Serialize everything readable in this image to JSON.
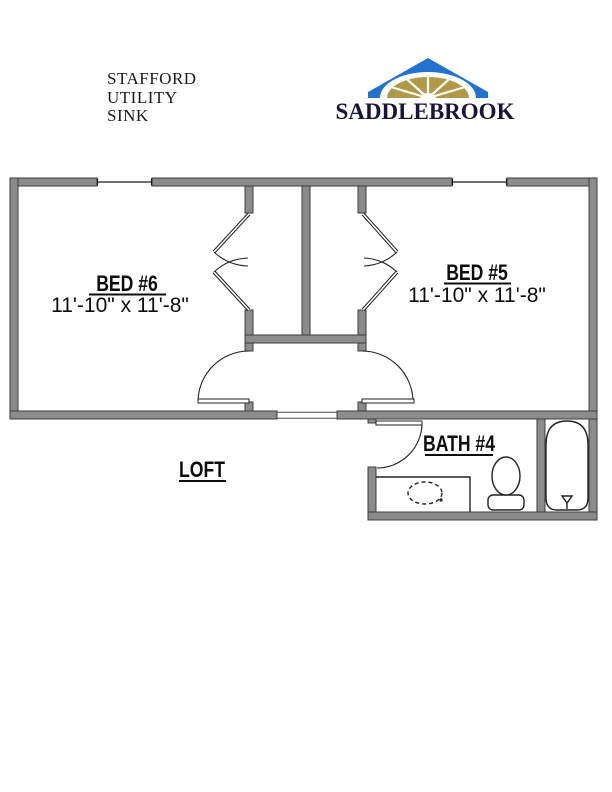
{
  "header": {
    "plan_name_lines": [
      "STAFFORD",
      "UTILITY",
      "SINK"
    ],
    "brand": "SADDLEBROOK"
  },
  "floor_plan": {
    "rooms": [
      {
        "name": "BED #6",
        "dimensions": "11'-10\" x 11'-8\""
      },
      {
        "name": "BED #5",
        "dimensions": "11'-10\" x 11'-8\""
      },
      {
        "name": "LOFT"
      },
      {
        "name": "BATH #4"
      }
    ],
    "fixtures": [
      "bifold-closet-door",
      "bifold-closet-door",
      "swing-door",
      "swing-door",
      "swing-door",
      "vanity-sink",
      "toilet",
      "bathtub"
    ],
    "windows": 2
  },
  "colors": {
    "wall_gray": "#8c8c8c",
    "wall_edge": "#3d3d3d",
    "line_dark": "#222222",
    "roof_blue": "#2273d0",
    "fan_gold": "#b2994a",
    "brand_navy": "#15153d"
  }
}
